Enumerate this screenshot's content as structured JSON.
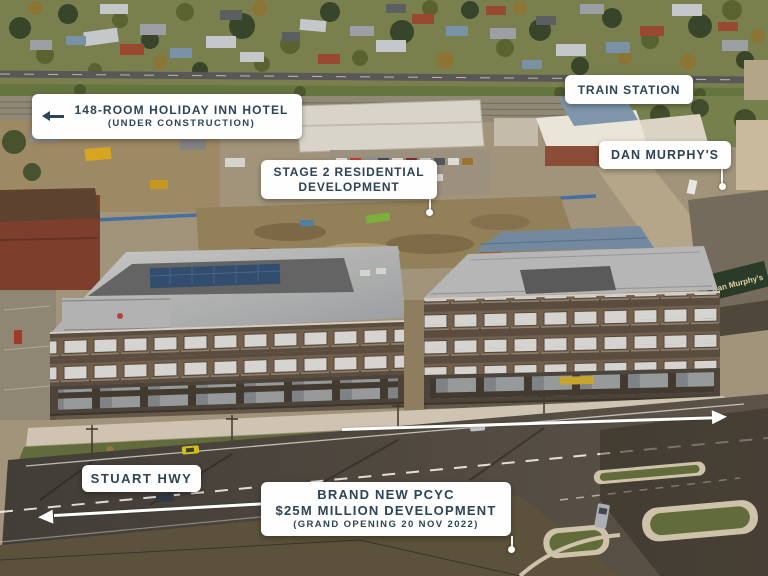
{
  "labels": {
    "holiday_inn": {
      "line1": "148-ROOM HOLIDAY INN HOTEL",
      "line2": "(UNDER CONSTRUCTION)"
    },
    "train_station": {
      "text": "TRAIN STATION"
    },
    "dan_murphys": {
      "text": "DAN MURPHY'S"
    },
    "stage2": {
      "line1": "STAGE 2 RESIDENTIAL",
      "line2": "DEVELOPMENT"
    },
    "stuart_hwy": {
      "text": "STUART HWY"
    },
    "pcyc": {
      "line1": "BRAND NEW PCYC",
      "line2": "$25M MILLION DEVELOPMENT",
      "line3": "(GRAND OPENING 20 NOV 2022)"
    }
  },
  "photo_signs": {
    "dan_murphys_storefront": "Dan Murphy's"
  },
  "colors": {
    "label_bg": "#fefefe",
    "label_text": "#2c4455",
    "annotation": "#ffffff"
  }
}
